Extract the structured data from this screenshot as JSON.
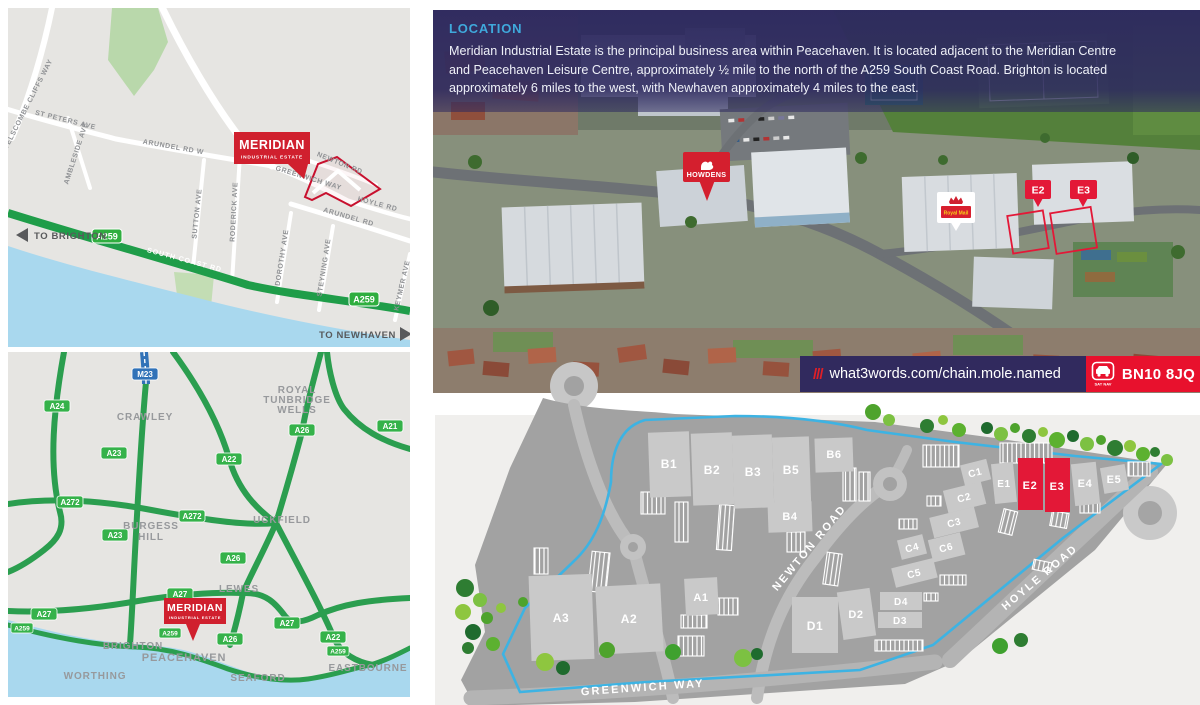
{
  "aerial": {
    "heading": "LOCATION",
    "body_lines": [
      "Meridian Industrial Estate is the principal business area within Peacehaven. It is located adjacent to the Meridian Centre",
      "and Peacehaven Leisure Centre, approximately ½ mile to the north of the A259 South Coast Road. Brighton is located",
      "approximately 6 miles to the west, with Newhaven approximately 4 miles to the east."
    ],
    "markers": {
      "howdens": "HOWDENS",
      "royal_mail": "Royal Mail",
      "e2": "E2",
      "e3": "E3"
    },
    "footer": {
      "slashes": "///",
      "what3words": "what3words.com/chain.mole.named",
      "satnav_label": "SAT NAV",
      "postcode": "BN10 8JQ"
    }
  },
  "street_map": {
    "estate": {
      "name": "MERIDIAN",
      "subtitle": "INDUSTRIAL ESTATE"
    },
    "directions": {
      "west": "TO BRIGHTON",
      "east": "TO NEWHAVEN"
    },
    "badges": [
      "A259",
      "A259"
    ],
    "roads": [
      "TELSCOMBE CLIFFS WAY",
      "ST PETERS AVE",
      "AMBLESIDE AVE",
      "ARUNDEL RD W",
      "GREENWICH WAY",
      "NEWTON RD",
      "HOYLE RD",
      "SUTTON AVE",
      "RODERICK AVE",
      "ARUNDEL RD",
      "DOROTHY AVE",
      "STEYNING AVE",
      "KEYMER AVE",
      "SOUTH COAST RD"
    ]
  },
  "region_map": {
    "estate": {
      "name": "MERIDIAN",
      "subtitle": "INDUSTRIAL ESTATE"
    },
    "places": [
      "CRAWLEY",
      "UCKFIELD",
      "LEWES",
      "WORTHING",
      "BRIGHTON",
      "PEACEHAVEN",
      "SEAFORD",
      "EASTBOURNE"
    ],
    "place_lines": {
      "rtw": [
        "ROYAL",
        "TUNBRIDGE",
        "WELLS"
      ],
      "burgess": [
        "BURGESS",
        "HILL"
      ]
    },
    "badges": [
      "M23",
      "A24",
      "A23",
      "A272",
      "A272",
      "A22",
      "A26",
      "A21",
      "A23",
      "A26",
      "A27",
      "A27",
      "A27",
      "A26",
      "A22",
      "A259",
      "A259",
      "A259"
    ]
  },
  "site_plan": {
    "roads": [
      "NEWTON ROAD",
      "HOYLE ROAD",
      "GREENWICH WAY"
    ],
    "units": [
      "B1",
      "B2",
      "B3",
      "B5",
      "B6",
      "B4",
      "C1",
      "C2",
      "C3",
      "C4",
      "C6",
      "C5",
      "E1",
      "E2",
      "E3",
      "E4",
      "E5",
      "A3",
      "A2",
      "A1",
      "D1",
      "D2",
      "D4",
      "D3"
    ],
    "highlighted_units": [
      "E2",
      "E3"
    ],
    "colors": {
      "highlight": "#e31837",
      "building": "#c9c9c9",
      "boundary": "#3db3e3"
    }
  }
}
